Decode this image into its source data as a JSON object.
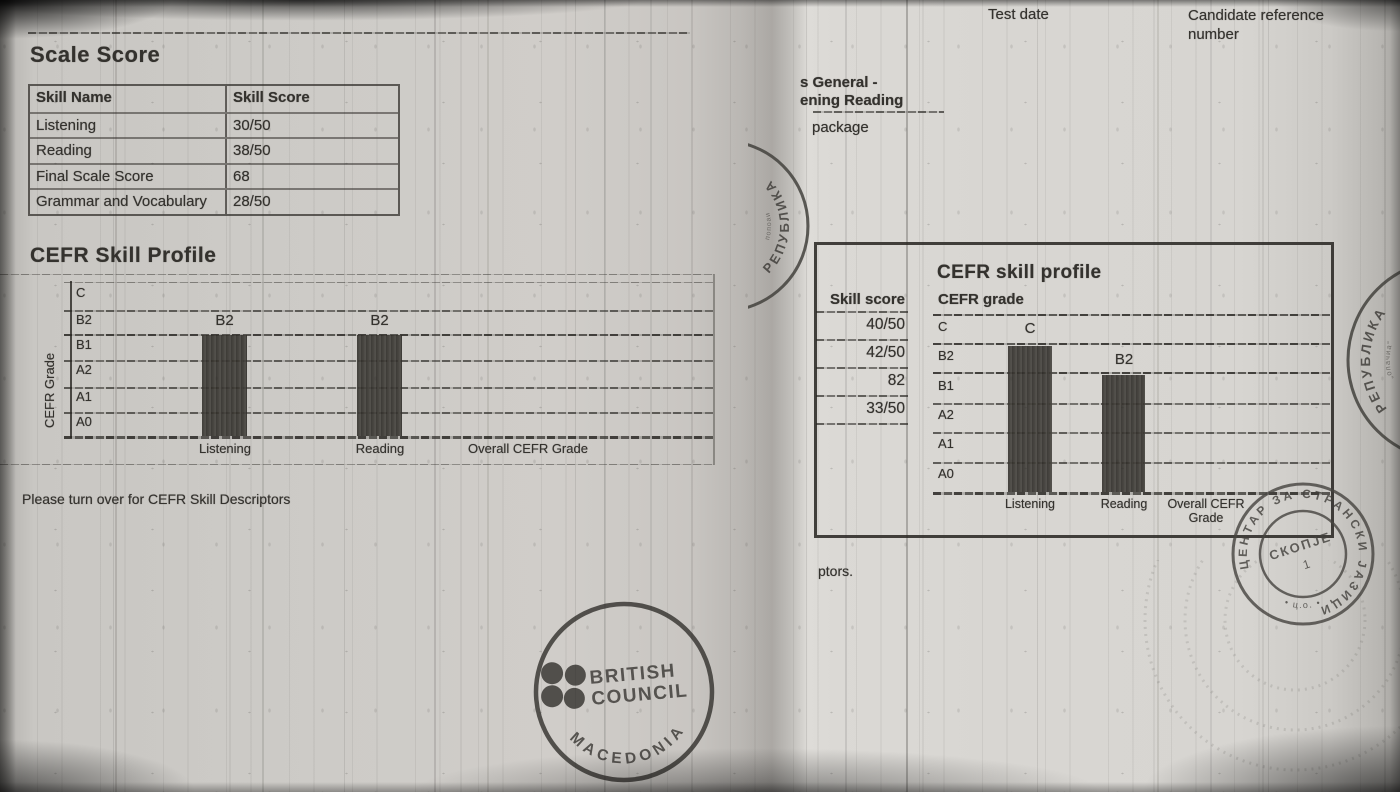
{
  "colors": {
    "paper": "#d2d0cc",
    "ink": "#34322e",
    "bar_ink": "#2b2925",
    "stamp_ink": "#44423e"
  },
  "left_page": {
    "scale_score_heading": "Scale Score",
    "table": {
      "headers": [
        "Skill Name",
        "Skill Score"
      ],
      "rows": [
        {
          "name": "Listening",
          "score": "30/50"
        },
        {
          "name": "Reading",
          "score": "38/50"
        },
        {
          "name": "Final Scale Score",
          "score": "68"
        },
        {
          "name": "Grammar and Vocabulary",
          "score": "28/50"
        }
      ]
    },
    "profile": {
      "heading": "CEFR Skill Profile",
      "y_axis_label": "CEFR Grade",
      "grades": [
        "C",
        "B2",
        "B1",
        "A2",
        "A1",
        "A0"
      ],
      "bar_labels": [
        "B2",
        "B2"
      ],
      "categories": [
        "Listening",
        "Reading",
        "Overall CEFR Grade"
      ]
    },
    "footer_note": "Please turn over for CEFR Skill Descriptors",
    "stamp": {
      "line1": "BRITISH",
      "line2": "COUNCIL",
      "arc_text": "MACEDONIA"
    }
  },
  "right_page": {
    "test_date_label": "Test date",
    "candidate_ref_label": "Candidate reference number",
    "product_line1": "s General -",
    "product_line2": "ening Reading",
    "product_line3": "package",
    "profile": {
      "heading": "CEFR skill profile",
      "skill_score_label": "Skill score",
      "cefr_grade_label": "CEFR grade",
      "skill_scores": [
        "40/50",
        "42/50",
        "82",
        "33/50"
      ],
      "grades": [
        "C",
        "B2",
        "B1",
        "A2",
        "A1",
        "A0"
      ],
      "bar_labels": [
        "C",
        "B2"
      ],
      "categories": [
        "Listening",
        "Reading",
        "Overall CEFR Grade"
      ]
    },
    "footer_fragment": "ptors.",
    "stamps": {
      "fold_arc_text": "РЕПУБЛИКА",
      "fold_arc_small": "попоаи",
      "edge_arc_text": "РЕПУБЛИКА",
      "edge_arc_small": "„опачиа“",
      "skopje_ring_text": "ЦЕНТАР ЗА СТРАНСКИ ЈАЗИЦИ",
      "skopje_bottom_text": "• ц.о. •",
      "skopje_center_line1": "СКОПЈЕ",
      "skopje_center_line2": "1"
    }
  },
  "chart_data": [
    {
      "type": "bar",
      "title": "CEFR Skill Profile",
      "ylabel": "CEFR Grade",
      "categories": [
        "Listening",
        "Reading",
        "Overall CEFR Grade"
      ],
      "grade_scale": [
        "A0",
        "A1",
        "A2",
        "B1",
        "B2",
        "C"
      ],
      "values": [
        "B2",
        "B2",
        null
      ],
      "grid": true,
      "legend": false
    },
    {
      "type": "bar",
      "title": "CEFR skill profile",
      "ylabel": "CEFR grade",
      "categories": [
        "Listening",
        "Reading",
        "Overall CEFR Grade"
      ],
      "grade_scale": [
        "A0",
        "A1",
        "A2",
        "B1",
        "B2",
        "C"
      ],
      "values": [
        "C",
        "B2",
        null
      ],
      "skill_scores": [
        "40/50",
        "42/50",
        "82",
        "33/50"
      ],
      "grid": true,
      "legend": false
    }
  ]
}
